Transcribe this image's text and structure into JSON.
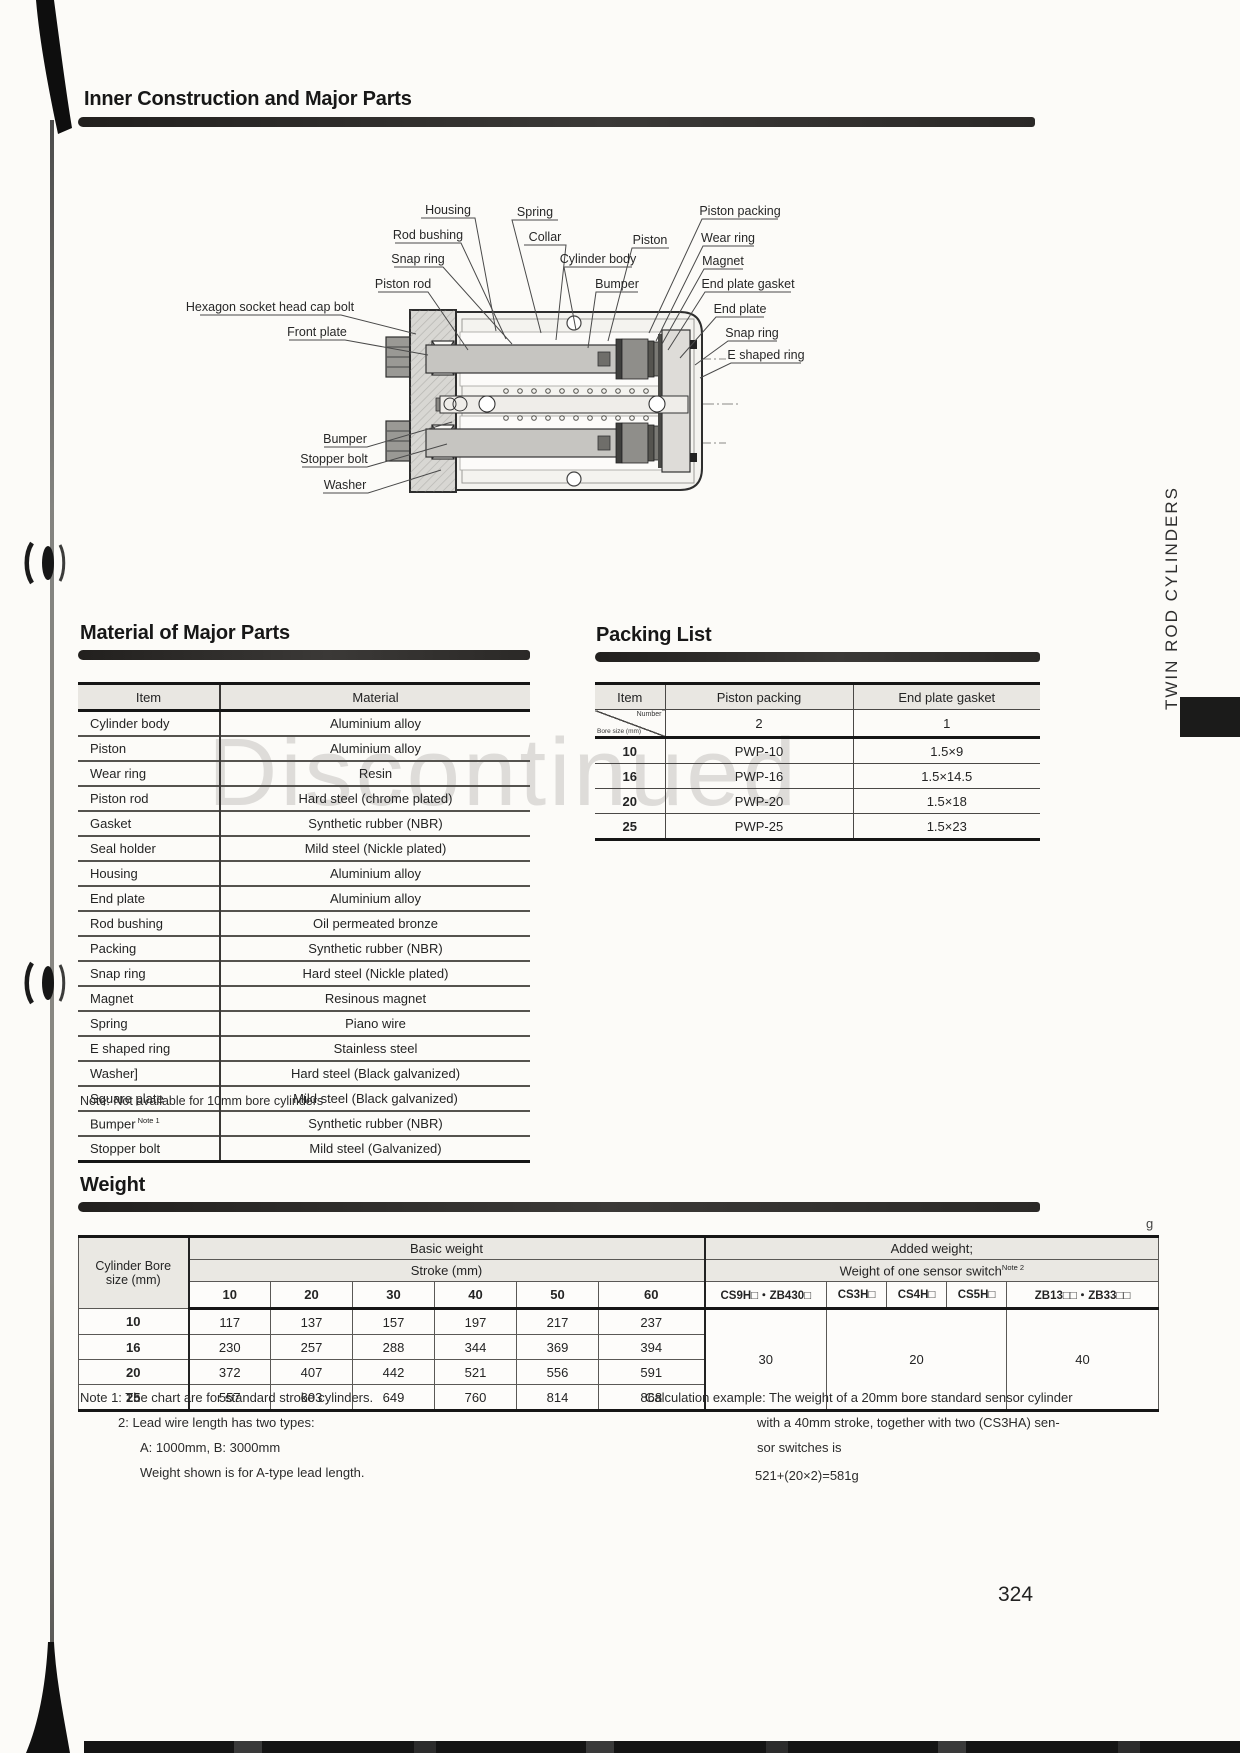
{
  "page": {
    "side_label": "TWIN ROD CYLINDERS",
    "page_number": "324",
    "watermark": "Discontinued",
    "unit_label": "g"
  },
  "titles": {
    "inner": "Inner Construction and Major Parts",
    "material": "Material of Major Parts",
    "packing": "Packing List",
    "weight": "Weight"
  },
  "diagram": {
    "labels": [
      {
        "text": "Housing",
        "x": 448,
        "y": 214,
        "line": "421,218 475,218 496,331"
      },
      {
        "text": "Spring",
        "x": 535,
        "y": 216,
        "line": "558,220 512,220 541,333"
      },
      {
        "text": "Piston packing",
        "x": 740,
        "y": 215,
        "line": "778,219 702,219 649,333"
      },
      {
        "text": "Rod bushing",
        "x": 428,
        "y": 239,
        "line": "395,243 461,243 506,339"
      },
      {
        "text": "Collar",
        "x": 545,
        "y": 241,
        "line": "524,245 566,245 556,340"
      },
      {
        "text": "Piston",
        "x": 650,
        "y": 244,
        "line": "669,248 632,248 608,341"
      },
      {
        "text": "Wear ring",
        "x": 728,
        "y": 242,
        "line": "754,246 703,246 656,341"
      },
      {
        "text": "Snap ring",
        "x": 418,
        "y": 263,
        "line": "394,267 443,267 512,344"
      },
      {
        "text": "Cylinder body",
        "x": 598,
        "y": 263,
        "line": "632,267 564,267 576,330"
      },
      {
        "text": "Magnet",
        "x": 723,
        "y": 265,
        "line": "743,269 704,269 662,344"
      },
      {
        "text": "Piston rod",
        "x": 403,
        "y": 288,
        "line": "378,292 428,292 468,350"
      },
      {
        "text": "Bumper",
        "x": 617,
        "y": 288,
        "line": "638,292 596,292 588,348"
      },
      {
        "text": "End plate gasket",
        "x": 748,
        "y": 288,
        "line": "791,292 705,292 668,350"
      },
      {
        "text": "Hexagon socket head cap bolt",
        "x": 270,
        "y": 311,
        "line": "200,315 341,315 416,334"
      },
      {
        "text": "End plate",
        "x": 740,
        "y": 313,
        "line": "764,317 716,317 680,358"
      },
      {
        "text": "Front plate",
        "x": 317,
        "y": 336,
        "line": "289,340 345,340 428,355"
      },
      {
        "text": "Snap ring",
        "x": 752,
        "y": 337,
        "line": "777,341 728,341 695,365"
      },
      {
        "text": "E shaped ring",
        "x": 766,
        "y": 359,
        "line": "801,363 731,363 700,378"
      },
      {
        "text": "Bumper",
        "x": 345,
        "y": 443,
        "line": "324,447 367,447 452,422"
      },
      {
        "text": "Stopper bolt",
        "x": 334,
        "y": 463,
        "line": "302,467 367,467 447,444"
      },
      {
        "text": "Washer",
        "x": 345,
        "y": 489,
        "line": "323,493 368,493 441,470"
      }
    ]
  },
  "material_table": {
    "headers": [
      "Item",
      "Material"
    ],
    "rows": [
      {
        "item": "Cylinder body",
        "material": "Aluminium alloy"
      },
      {
        "item": "Piston",
        "material": "Aluminium alloy"
      },
      {
        "item": "Wear ring",
        "material": "Resin"
      },
      {
        "item": "Piston rod",
        "material": "Hard steel (chrome plated)"
      },
      {
        "item": "Gasket",
        "material": "Synthetic rubber (NBR)"
      },
      {
        "item": "Seal holder",
        "material": "Mild steel (Nickle plated)"
      },
      {
        "item": "Housing",
        "material": "Aluminium alloy"
      },
      {
        "item": "End plate",
        "material": "Aluminium alloy"
      },
      {
        "item": "Rod bushing",
        "material": "Oil permeated bronze"
      },
      {
        "item": "Packing",
        "material": "Synthetic rubber (NBR)"
      },
      {
        "item": "Snap ring",
        "material": "Hard steel (Nickle plated)"
      },
      {
        "item": "Magnet",
        "material": "Resinous magnet"
      },
      {
        "item": "Spring",
        "material": "Piano wire"
      },
      {
        "item": "E shaped ring",
        "material": "Stainless steel"
      },
      {
        "item": "Washer]",
        "material": "Hard steel (Black galvanized)"
      },
      {
        "item": "Square plate",
        "material": "Mild steel (Black galvanized)"
      },
      {
        "item": "Bumper",
        "sup": "Note 1",
        "material": "Synthetic rubber (NBR)"
      },
      {
        "item": "Stopper bolt",
        "material": "Mild steel (Galvanized)"
      }
    ],
    "note": "Note: Not available for 10mm bore cylinders"
  },
  "packing_table": {
    "headers": [
      "Item",
      "Piston packing",
      "End plate gasket"
    ],
    "diag_top": "Number",
    "diag_bottom": "Bore size (mm)",
    "counts": [
      "2",
      "1"
    ],
    "rows": [
      {
        "bore": "10",
        "packing": "PWP-10",
        "gasket": "1.5×9"
      },
      {
        "bore": "16",
        "packing": "PWP-16",
        "gasket": "1.5×14.5"
      },
      {
        "bore": "20",
        "packing": "PWP-20",
        "gasket": "1.5×18"
      },
      {
        "bore": "25",
        "packing": "PWP-25",
        "gasket": "1.5×23"
      }
    ]
  },
  "weight_table": {
    "corner": "Cylinder Bore size (mm)",
    "basic_header": "Basic weight",
    "stroke_header": "Stroke (mm)",
    "added_header": "Added weight;",
    "sensor_header": "Weight of one sensor switch",
    "sensor_sup": "Note 2",
    "stroke_cols": [
      "10",
      "20",
      "30",
      "40",
      "50",
      "60"
    ],
    "sensor_cols": [
      "CS9H□・ZB430□",
      "CS3H□",
      "CS4H□",
      "CS5H□",
      "ZB13□□・ZB33□□"
    ],
    "rows": [
      {
        "bore": "10",
        "values": [
          "117",
          "137",
          "157",
          "197",
          "217",
          "237"
        ]
      },
      {
        "bore": "16",
        "values": [
          "230",
          "257",
          "288",
          "344",
          "369",
          "394"
        ]
      },
      {
        "bore": "20",
        "values": [
          "372",
          "407",
          "442",
          "521",
          "556",
          "591"
        ]
      },
      {
        "bore": "25",
        "values": [
          "557",
          "603",
          "649",
          "760",
          "814",
          "868"
        ]
      }
    ],
    "added_values": [
      "30",
      "20",
      "40"
    ]
  },
  "notes": {
    "line1": "Note 1: The chart are for standard stroke cylinders.",
    "line2": "2: Lead wire length has two types:",
    "line3": "A: 1000mm, B: 3000mm",
    "line4": "Weight shown is for A-type lead length."
  },
  "calc": {
    "line1": "Calculation example: The weight of a 20mm bore standard sensor cylinder",
    "line2": "with a 40mm stroke, together with two (CS3HA) sen-",
    "line3": "sor switches is",
    "line4": "521+(20×2)=581g"
  }
}
